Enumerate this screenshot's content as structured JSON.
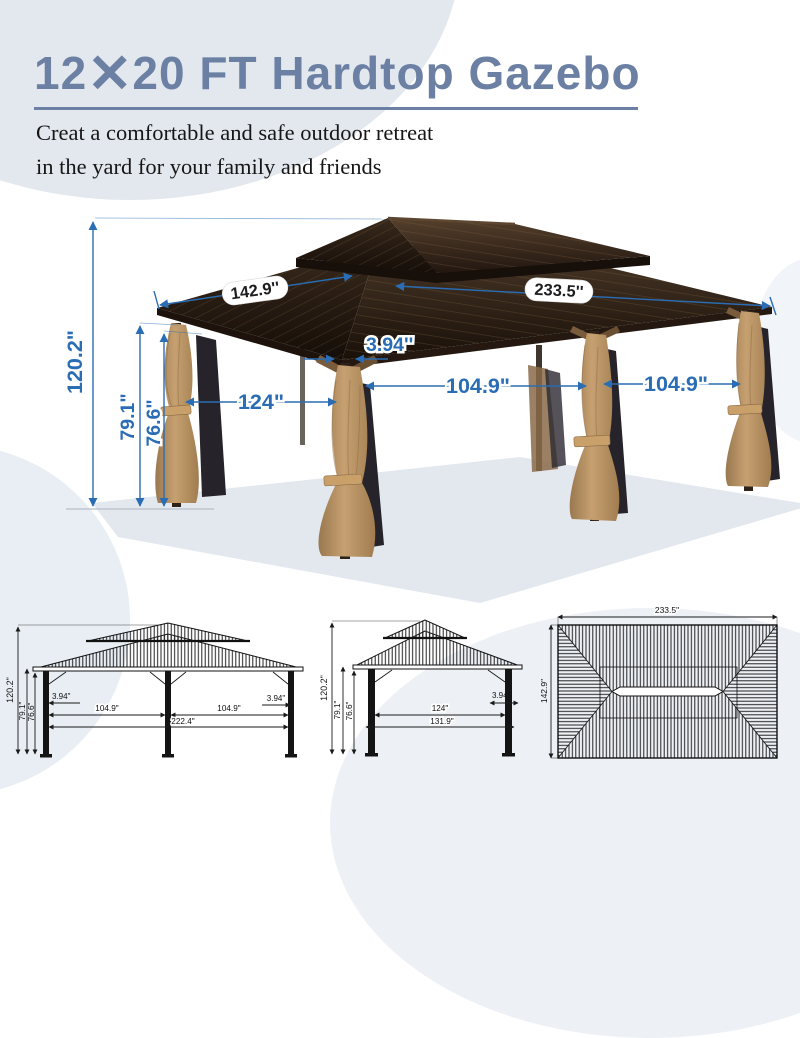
{
  "header": {
    "title_num1": "12",
    "title_x": "✕",
    "title_rest": "20 FT Hardtop Gazebo",
    "subtitle_line1": "Creat a comfortable and safe outdoor retreat",
    "subtitle_line2": "in the yard for your family and friends"
  },
  "photo": {
    "height_total": "120.2\"",
    "height_front": "79.1\"",
    "height_clear": "76.6\"",
    "roof_depth": "142.9''",
    "roof_width": "233.5''",
    "post_width": "3.94''",
    "side_span": "124\"",
    "bay_left": "104.9\"",
    "bay_right": "104.9\""
  },
  "front_view": {
    "height_total": "120.2\"",
    "height_front": "79.1\"",
    "height_clear": "76.6\"",
    "post_left": "3.94\"",
    "bay_left": "104.9\"",
    "bay_right": "104.9\"",
    "post_right": "3.94\"",
    "total_width": "222.4\""
  },
  "side_view": {
    "height_total": "120.2\"",
    "height_front": "79.1\"",
    "height_clear": "76.6\"",
    "post": "3.94\"",
    "span": "124\"",
    "total_depth": "131.9\""
  },
  "top_view": {
    "width": "233.5\"",
    "depth": "142.9\""
  },
  "colors": {
    "dimension_blue": "#2a6db4",
    "title_blue": "#6b80a3",
    "roof_brown": "#3a2a1c",
    "curtain_tan": "#b6905f"
  }
}
